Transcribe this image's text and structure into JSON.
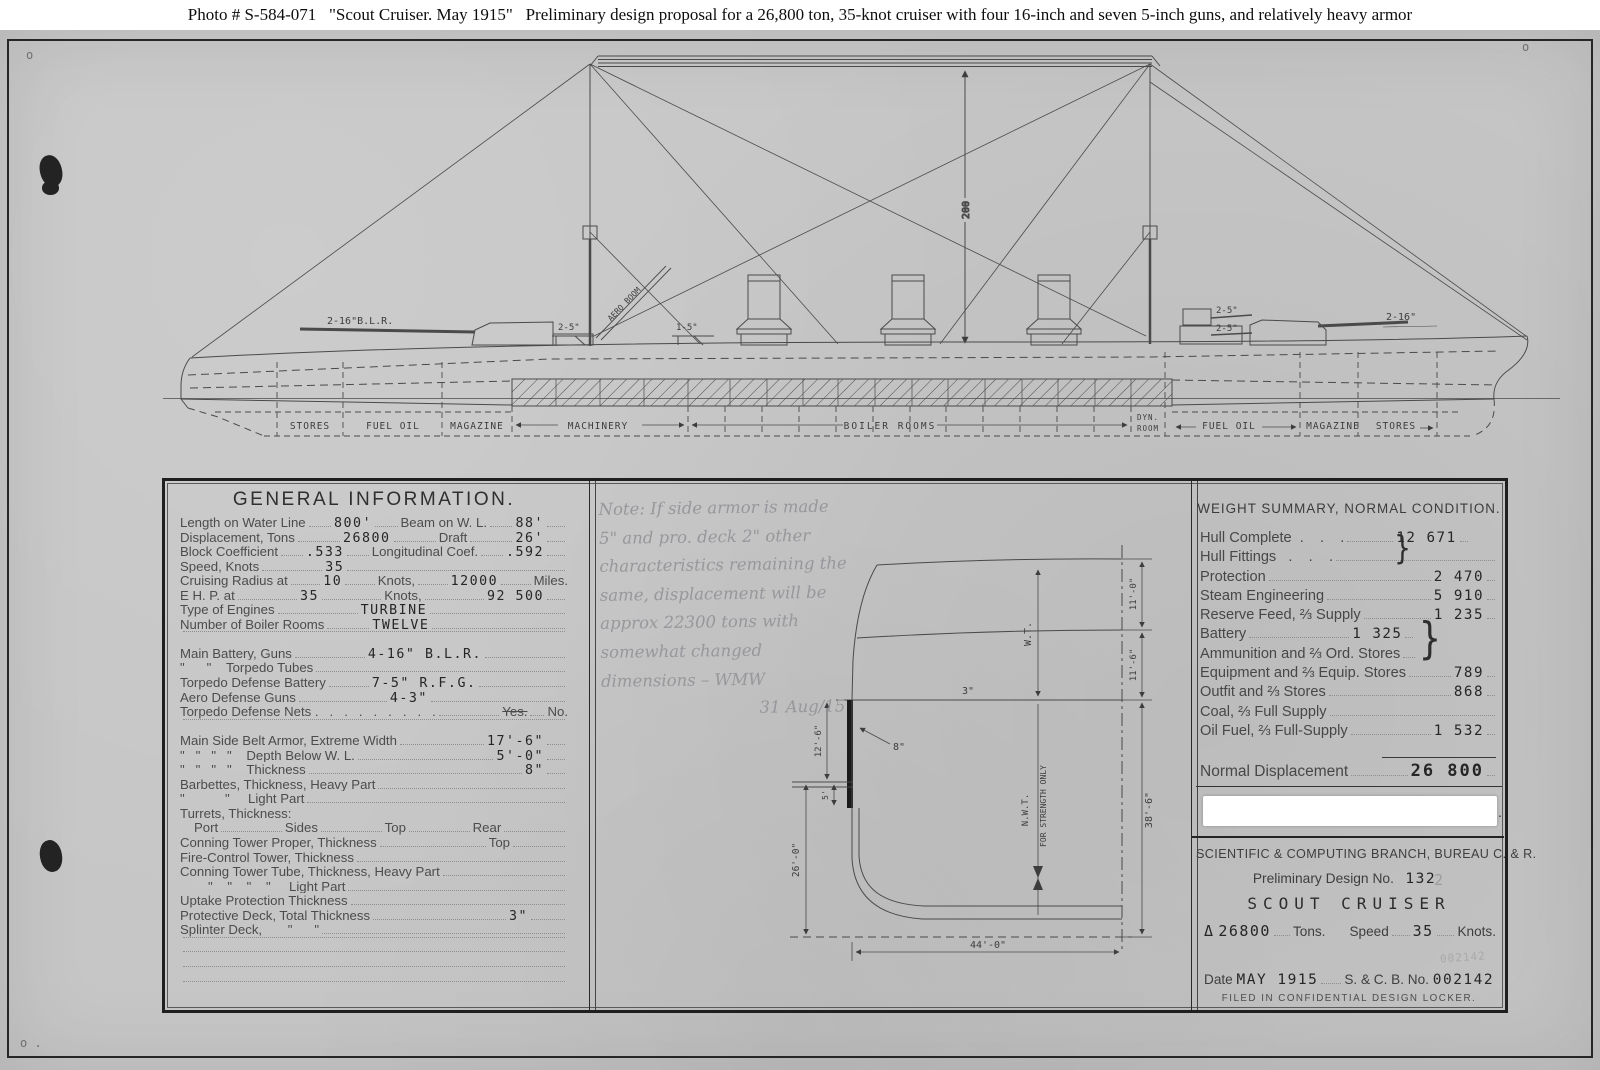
{
  "caption": "Photo # S-584-071   \"Scout Cruiser.  May 1915\"   Preliminary design proposal for a 26,800 ton, 35-knot cruiser with four 16-inch and seven 5-inch guns, and relatively heavy armor",
  "marks": {
    "top_left": "o",
    "top_right": "o",
    "bottom_left": "o ."
  },
  "profile": {
    "dim_height": "200",
    "aero_boom_label": "AERO BOOM",
    "fwd_main_guns": "2-16\"B.L.R.",
    "fwd_sec_gun": "2-5\"",
    "mid_sec_gun": "1-5\"",
    "aft_sec_gun_upper": "2-5\"",
    "aft_sec_gun_lower": "2-5\"",
    "aft_main_guns": "2-16\"",
    "compartments": [
      "STORES",
      "FUEL OIL",
      "MAGAZINE",
      "MACHINERY",
      "BOILER ROOMS",
      "DYN.",
      "ROOM",
      "FUEL OIL",
      "MAGAZINE",
      "STORES"
    ]
  },
  "section": {
    "deck_thickness": "3\"",
    "belt_thickness": "8\"",
    "belt_depth": "12'-6\"",
    "shelf_depth": "5'",
    "depth_keel": "26'-0\"",
    "half_beam": "44'-0\"",
    "depth_total": "38'-6\"",
    "tween_upper": "11'-0\"",
    "tween_lower": "11'-6\"",
    "wt_label": "W.T.",
    "nwt_label": "N.W.T.",
    "strength_label": "FOR STRENGTH ONLY"
  },
  "general_info": {
    "title": "GENERAL INFORMATION.",
    "rows": [
      {
        "l": "Length on Water Line",
        "v": "800'",
        "l2": "Beam on W. L.",
        "v2": "88'"
      },
      {
        "l": "Displacement, Tons",
        "v": "26800",
        "l2": "Draft",
        "v2": "26'"
      },
      {
        "l": "Block Coefficient",
        "v": ".533",
        "l2": "Longitudinal Coef.",
        "v2": ".592"
      },
      {
        "l": "Speed, Knots",
        "v": "35"
      },
      {
        "l": "Cruising Radius at",
        "v": "10",
        "l2": "Knots,",
        "v2": "12000",
        "l3": "Miles."
      },
      {
        "l": "E H. P. at",
        "v": "35",
        "l2": "Knots,",
        "v2": "92 500"
      },
      {
        "l": "Type of Engines",
        "v": "TURBINE"
      },
      {
        "l": "Number of Boiler Rooms",
        "v": "TWELVE"
      },
      {
        "l": "Main Battery, Guns",
        "v": "4-16\" B.L.R."
      },
      {
        "l": "\"      \"    Torpedo Tubes",
        "v": ""
      },
      {
        "l": "Torpedo Defense Battery",
        "v": "7-5\" R.F.G."
      },
      {
        "l": "Aero Defense Guns",
        "v": "4-3\""
      },
      {
        "l": "Torpedo Defense Nets .   .   .   .   .   .   .   .   .",
        "yes": "Yes.",
        "no": "No."
      },
      {
        "l": "Main Side Belt Armor, Extreme Width",
        "v": "17'-6\""
      },
      {
        "l": "\"   \"   \"   \"    Depth Below W. L.",
        "v": "5'-0\""
      },
      {
        "l": "\"   \"   \"   \"    Thickness",
        "v": "8\""
      },
      {
        "l": "Barbettes, Thickness, Heavy Part",
        "v": ""
      },
      {
        "l": "\"           \"     Light Part",
        "v": ""
      },
      {
        "l": "Turrets, Thickness:"
      },
      {
        "l": "Port",
        "l2": "Sides",
        "l3": "Top",
        "l4": "Rear"
      },
      {
        "l": "Conning Tower Proper, Thickness",
        "l2": "Top"
      },
      {
        "l": "Fire-Control Tower, Thickness"
      },
      {
        "l": "Conning Tower Tube, Thickness, Heavy Part"
      },
      {
        "l": "\"    \"    \"    \"     Light Part"
      },
      {
        "l": "Uptake Protection Thickness"
      },
      {
        "l": "Protective Deck, Total Thickness",
        "v": "3\""
      },
      {
        "l": "Splinter Deck,       \"      \""
      }
    ]
  },
  "note": {
    "lines": [
      "Note: If side armor is made",
      "5\" and pro. deck 2\" other",
      "characteristics remaining the",
      "same, displacement will be",
      "approx 22300 tons with",
      "somewhat changed",
      "dimensions – WMW"
    ],
    "signature": "31 Aug/15"
  },
  "weight_summary": {
    "title": "WEIGHT SUMMARY,  NORMAL  CONDITION.",
    "brace1": "}",
    "brace2": "}",
    "rows": [
      {
        "l": "Hull Complete  .    .    .",
        "v": "12 671"
      },
      {
        "l": "Hull Fittings   .    .    ."
      },
      {
        "l": "Protection",
        "v": "2 470"
      },
      {
        "l": "Steam Engineering",
        "v": "5 910"
      },
      {
        "l": "Reserve Feed, ⅔ Supply",
        "v": "1 235"
      },
      {
        "l": "Battery",
        "v": "1 325"
      },
      {
        "l": "Ammunition and ⅔ Ord. Stores"
      },
      {
        "l": "Equipment and ⅔ Equip. Stores",
        "v": "789"
      },
      {
        "l": "Outfit and ⅔ Stores",
        "v": "868"
      },
      {
        "l": "Coal, ⅔ Full Supply"
      },
      {
        "l": "Oil Fuel, ⅔ Full-Supply",
        "v": "1 532"
      }
    ],
    "total_label": "Normal Displacement",
    "total_value": "26 800"
  },
  "branch": {
    "org": "SCIENTIFIC  &  COMPUTING  BRANCH,  BUREAU  C.  &  R.",
    "design_label": "Preliminary  Design  No.",
    "design_no": "132",
    "design_scribble": "2",
    "ship_type": "SCOUT CRUISER",
    "delta": "Δ",
    "tons_value": "26800",
    "tons_label": "Tons.",
    "speed_label": "Speed",
    "speed_value": "35",
    "knots_label": "Knots.",
    "pencil": "002142",
    "date_label": "Date",
    "date_value": "MAY  1915",
    "scb_label": "S. & C. B. No.",
    "scb_value": "002142",
    "filed": "FILED  IN  CONFIDENTIAL  DESIGN  LOCKER.",
    "period": "."
  }
}
